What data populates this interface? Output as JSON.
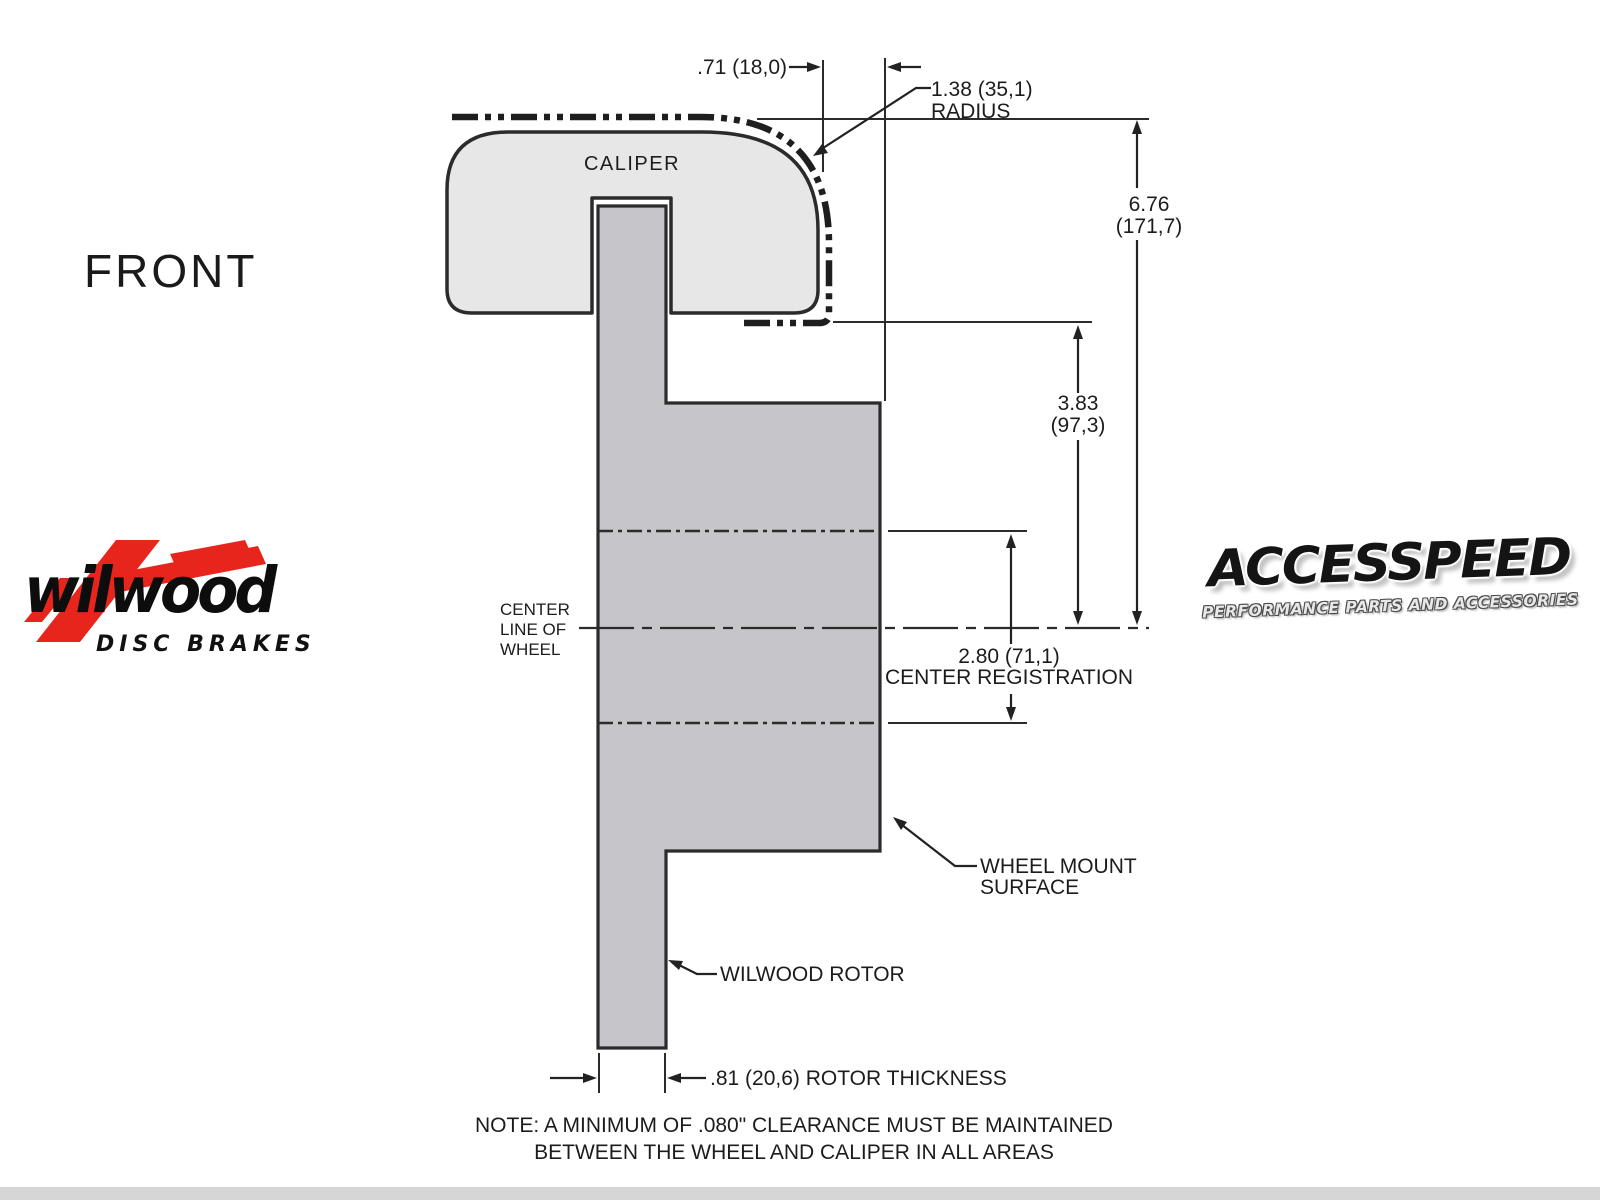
{
  "front_label": "FRONT",
  "drawing": {
    "caliper_label": "CALIPER",
    "dimensions": {
      "wheel_to_mount": ".71 (18,0)",
      "radius": [
        "1.38 (35,1)",
        "RADIUS"
      ],
      "overall_height": [
        "6.76",
        "(171,7)"
      ],
      "mount_to_center": [
        "3.83",
        "(97,3)"
      ],
      "center_registration": [
        "2.80 (71,1)",
        "CENTER REGISTRATION"
      ],
      "rotor_thickness": ".81 (20,6) ROTOR THICKNESS"
    },
    "labels": {
      "center_line": [
        "CENTER",
        "LINE OF",
        "WHEEL"
      ],
      "wheel_mount_surface": [
        "WHEEL MOUNT",
        "SURFACE"
      ],
      "wilwood_rotor": "WILWOOD ROTOR"
    },
    "note": [
      "NOTE: A MINIMUM OF .080\" CLEARANCE MUST BE MAINTAINED",
      "BETWEEN THE WHEEL AND CALIPER IN ALL AREAS"
    ]
  },
  "logos": {
    "wilwood": {
      "name": "wilwood",
      "tagline": "DISC BRAKES",
      "red": "#e8251d"
    },
    "accesspeed": {
      "name": "ACCESSPEED",
      "tagline": "PERFORMANCE PARTS AND ACCESSORIES"
    }
  },
  "colors": {
    "caliper_fill": "#e7e7e7",
    "rotor_fill": "#c6c6ca",
    "line": "#2b2b2b",
    "phantom": "#1e1e1e"
  }
}
